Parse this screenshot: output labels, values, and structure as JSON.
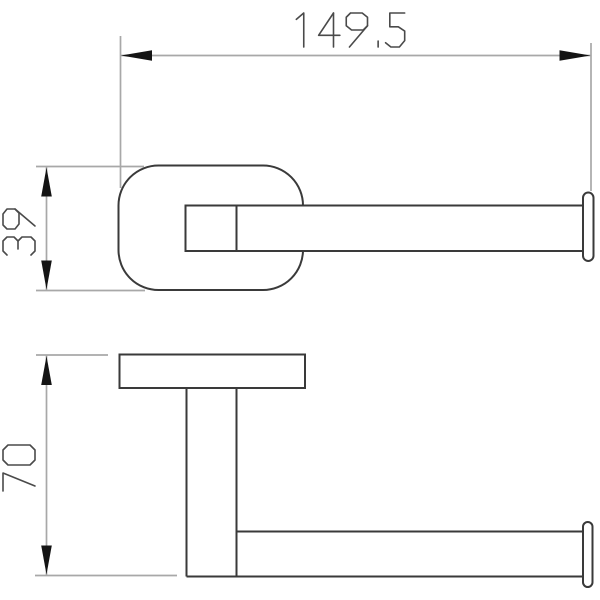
{
  "drawing": {
    "type": "technical-dimension-drawing",
    "background": "#ffffff",
    "colors": {
      "object_line": "#3a3a3a",
      "dimension_line": "#a8a8a8",
      "arrowhead": "#141414",
      "text": "#4a4a4a"
    },
    "views": {
      "top": {
        "name": "top-view"
      },
      "side": {
        "name": "side-view"
      }
    },
    "dimensions": {
      "width": {
        "value": "149.5",
        "orientation": "horizontal"
      },
      "plate_height": {
        "value": "39",
        "orientation": "vertical"
      },
      "height": {
        "value": "70",
        "orientation": "vertical"
      }
    }
  }
}
